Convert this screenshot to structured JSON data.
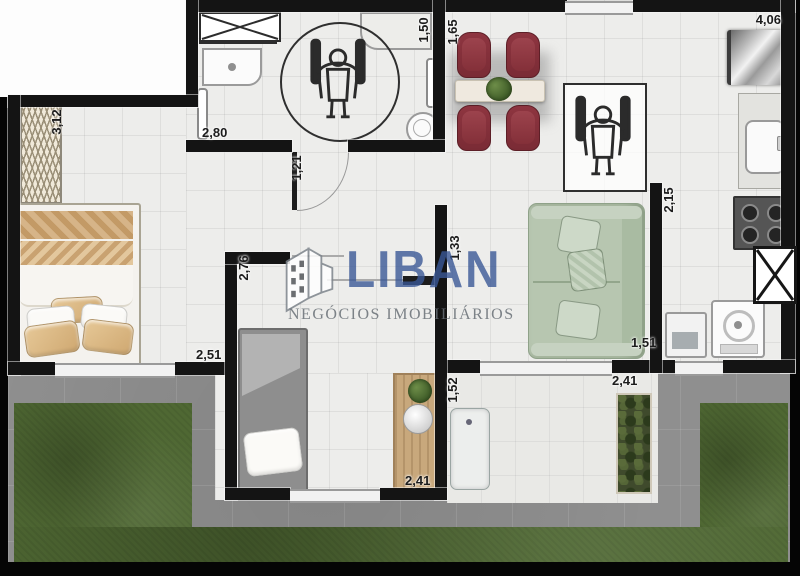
{
  "watermark": {
    "brand": "LIBAN",
    "subtitle": "NEGÓCIOS IMOBILIÁRIOS"
  },
  "dimensions": {
    "wardrobe_length": "3,12",
    "bathroom_width": "2,80",
    "bathroom_depth": "1,50",
    "hall_door_width": "1,21",
    "dining_depth": "1,65",
    "kitchen_width": "4,06",
    "kitchen_depth": "2,15",
    "bedroom2_depth": "2,76",
    "bedroom1_width": "2,51",
    "living_wall": "1,33",
    "patio_door_depth": "1,52",
    "bedroom2_width": "2,41",
    "patio_width": "2,41",
    "laundry_width": "1,51"
  },
  "icons": [
    "wheelchair-icon",
    "building-logo-icon",
    "duct-x-icon",
    "window-x-icon"
  ],
  "colors": {
    "wall": "#141414",
    "floor": "#ededeb",
    "grass": "#4f6833",
    "concrete": "#8f8f8f",
    "patio": "#e9e9e6",
    "chair_red": "#8e3540",
    "sofa_sage": "#b7c6b0",
    "bed_tan": "#d6b488",
    "wood": "#c8a87c",
    "brand_blue": "#44659e",
    "subtitle_gray": "#85898d"
  }
}
